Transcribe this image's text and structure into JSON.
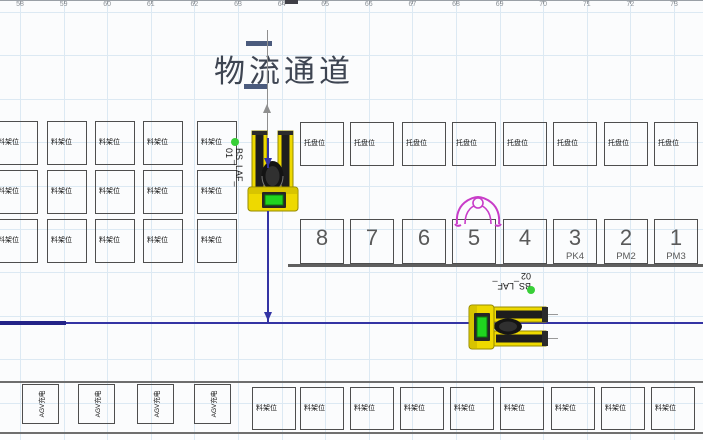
{
  "ruler": {
    "ticks": [
      "58",
      "59",
      "60",
      "61",
      "62",
      "63",
      "64",
      "65",
      "66",
      "67",
      "68",
      "69",
      "70",
      "71",
      "72",
      "73"
    ]
  },
  "title": "物流通道",
  "left_rack_grid": {
    "rows": [
      [
        "料架位",
        "料架位",
        "料架位",
        "料架位",
        "料架位"
      ],
      [
        "料架位",
        "料架位",
        "料架位",
        "料架位",
        "料架位"
      ],
      [
        "料架位",
        "料架位",
        "料架位",
        "料架位",
        "料架位"
      ]
    ]
  },
  "pallet_row": {
    "cells": [
      "托盘位",
      "托盘位",
      "托盘位",
      "托盘位",
      "托盘位",
      "托盘位",
      "托盘位",
      "托盘位"
    ]
  },
  "station_row": {
    "cells": [
      {
        "num": "8",
        "sub": ""
      },
      {
        "num": "7",
        "sub": ""
      },
      {
        "num": "6",
        "sub": ""
      },
      {
        "num": "5",
        "sub": ""
      },
      {
        "num": "4",
        "sub": ""
      },
      {
        "num": "3",
        "sub": "PK4"
      },
      {
        "num": "2",
        "sub": "PM2"
      },
      {
        "num": "1",
        "sub": "PM3"
      }
    ]
  },
  "machines": [
    {
      "id": "BS_LAF_01",
      "label_line1": "BS_LAF_",
      "label_line2": "01"
    },
    {
      "id": "BS_LAF_02",
      "label_line1": "BS_LAF_",
      "label_line2": "02"
    }
  ],
  "agv_row": {
    "cells": [
      "AGV充电",
      "AGV充电",
      "AGV充电",
      "AGV充电"
    ]
  },
  "bottom_rack_row": {
    "cells": [
      "料架位",
      "料架位",
      "料架位",
      "料架位",
      "料架位",
      "料架位",
      "料架位",
      "料架位",
      "料架位"
    ]
  },
  "colors": {
    "machine_body": "#eed900",
    "machine_screen_green": "#1fd41f",
    "status_dot_green": "#38cf38",
    "agv_path_blue": "#3434a4",
    "operator_magenta": "#c83cc8",
    "grid_blue": "#dce9f3"
  }
}
